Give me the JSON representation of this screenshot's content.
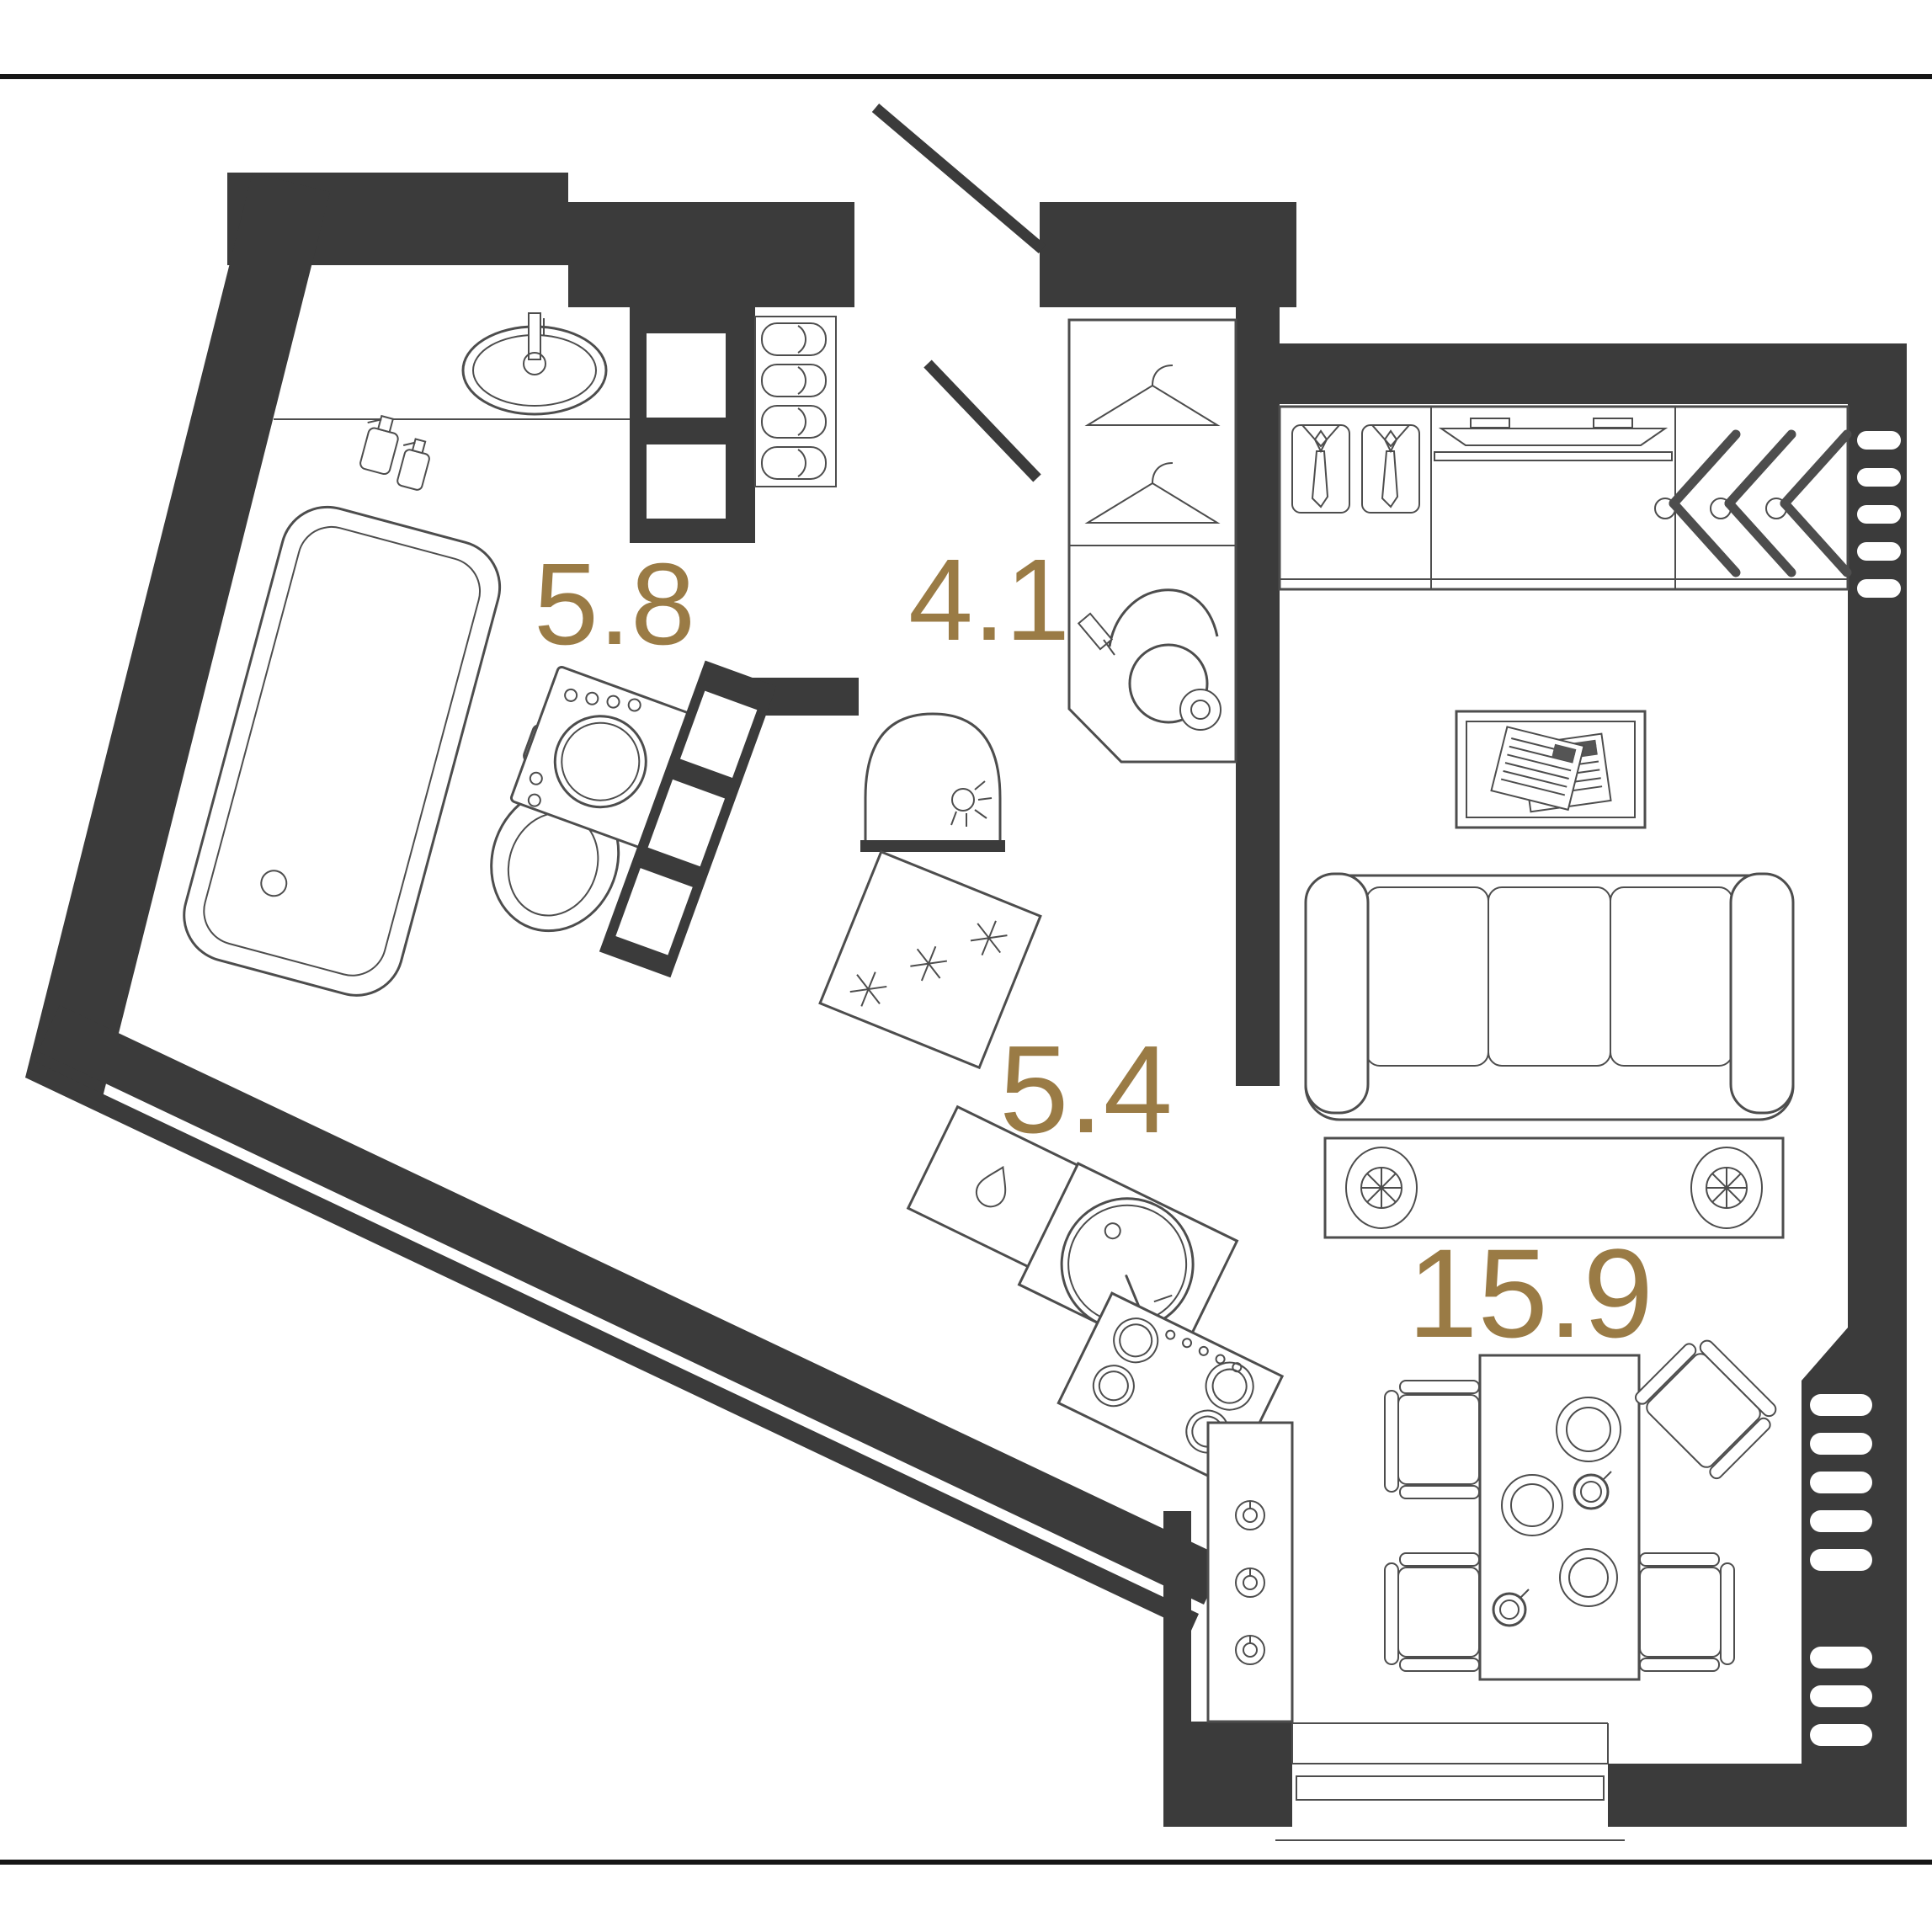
{
  "page": {
    "type": "apartment floor plan",
    "view": "top-down architectural drawing"
  },
  "colors": {
    "wall": "#3b3b3b",
    "furniture-line": "#4d4d4d",
    "area-label": "#9a7b45",
    "background": "#ffffff",
    "frame-line": "#161616"
  },
  "rooms": {
    "bathroom": {
      "name": "bathroom",
      "label": "5.8",
      "fixtures": [
        "wash-basin",
        "spray-bottles",
        "bathtub",
        "toilet",
        "washing-machine",
        "shelf-niche-wall"
      ]
    },
    "hallway": {
      "name": "hallway",
      "label": "4.1",
      "fixtures": [
        "entrance-door",
        "slipper-shelf",
        "duct-shaft",
        "interior-door",
        "coat-hangers",
        "vacuum-cleaner",
        "wall-lamp"
      ]
    },
    "kitchen": {
      "name": "kitchen",
      "label": "5.4",
      "fixtures": [
        "freezer-cabinet",
        "cabinet-with-drop",
        "kitchen-sink",
        "stove",
        "oven-cabinet"
      ]
    },
    "living_room": {
      "name": "living room",
      "label": "15.9",
      "fixtures": [
        "wardrobe-shirts",
        "tv-panel",
        "wardrobe-coat-hangers",
        "rug-with-magazines",
        "sofa",
        "coffee-table",
        "dining-table",
        "dining-chairs",
        "plates",
        "cups",
        "radiator",
        "window"
      ]
    }
  }
}
